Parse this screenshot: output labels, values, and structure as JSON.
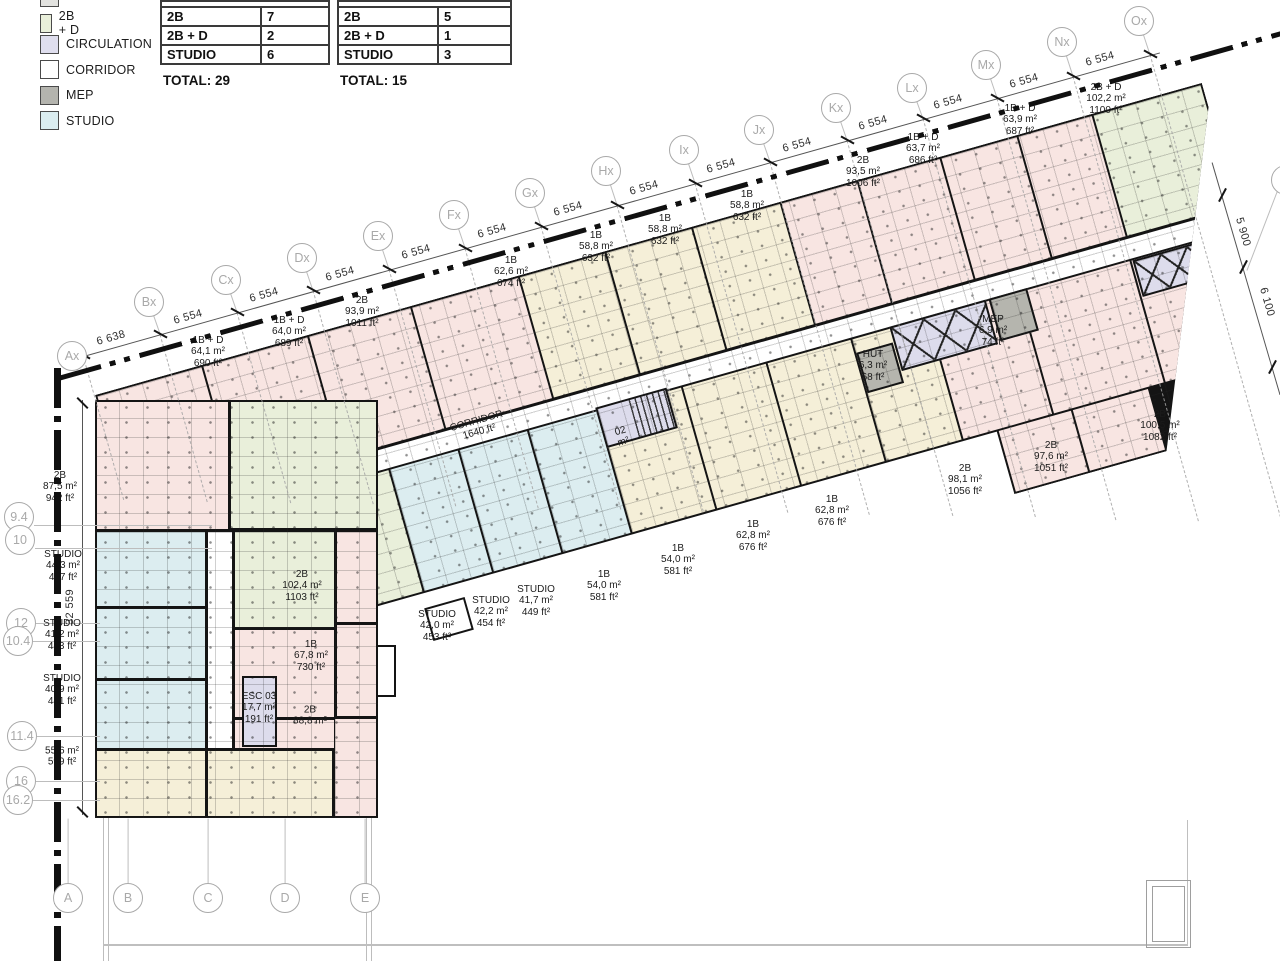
{
  "legend": {
    "items": [
      {
        "label": "2B + D",
        "color": "#e9efda"
      },
      {
        "label": "CIRCULATION",
        "color": "#dfdeee"
      },
      {
        "label": "CORRIDOR",
        "color": "#ffffff"
      },
      {
        "label": "MEP",
        "color": "#b4b4ae"
      },
      {
        "label": "STUDIO",
        "color": "#dbedf0"
      }
    ]
  },
  "tables": [
    {
      "rows": [
        [
          "2B",
          "7"
        ],
        [
          "2B + D",
          "2"
        ],
        [
          "STUDIO",
          "6"
        ]
      ],
      "total": "TOTAL: 29",
      "x": 160,
      "y": 0,
      "w": 170,
      "labelw": 100
    },
    {
      "rows": [
        [
          "2B",
          "5"
        ],
        [
          "2B + D",
          "1"
        ],
        [
          "STUDIO",
          "3"
        ]
      ],
      "total": "TOTAL: 15",
      "x": 337,
      "y": 0,
      "w": 175,
      "labelw": 100
    }
  ],
  "grid": {
    "top_bubbles": [
      {
        "label": "Ax",
        "x": 72,
        "y": 356
      },
      {
        "label": "Bx",
        "x": 149,
        "y": 302
      },
      {
        "label": "Cx",
        "x": 226,
        "y": 280
      },
      {
        "label": "Dx",
        "x": 302,
        "y": 258
      },
      {
        "label": "Ex",
        "x": 378,
        "y": 236
      },
      {
        "label": "Fx",
        "x": 454,
        "y": 215
      },
      {
        "label": "Gx",
        "x": 530,
        "y": 193
      },
      {
        "label": "Hx",
        "x": 606,
        "y": 171
      },
      {
        "label": "Ix",
        "x": 684,
        "y": 150
      },
      {
        "label": "Jx",
        "x": 759,
        "y": 130
      },
      {
        "label": "Kx",
        "x": 836,
        "y": 108
      },
      {
        "label": "Lx",
        "x": 912,
        "y": 88
      },
      {
        "label": "Mx",
        "x": 986,
        "y": 65
      },
      {
        "label": "Nx",
        "x": 1062,
        "y": 42
      },
      {
        "label": "Ox",
        "x": 1139,
        "y": 21
      }
    ],
    "left_bubbles": [
      {
        "label": "9.4",
        "x": 19,
        "y": 517
      },
      {
        "label": "10",
        "x": 20,
        "y": 540
      },
      {
        "label": "12",
        "x": 21,
        "y": 623
      },
      {
        "label": "10.4",
        "x": 18,
        "y": 641
      },
      {
        "label": "11.4",
        "x": 22,
        "y": 736
      },
      {
        "label": "16",
        "x": 21,
        "y": 781
      },
      {
        "label": "16.2",
        "x": 18,
        "y": 800
      }
    ],
    "bottom_bubbles": [
      {
        "label": "A",
        "x": 68,
        "y": 898
      },
      {
        "label": "B",
        "x": 128,
        "y": 898
      },
      {
        "label": "C",
        "x": 208,
        "y": 898
      },
      {
        "label": "D",
        "x": 285,
        "y": 898
      },
      {
        "label": "E",
        "x": 365,
        "y": 898
      }
    ],
    "right_partial_bubble": {
      "label": "",
      "x": 1286,
      "y": 180
    },
    "top_dims": [
      {
        "t": "6 638",
        "x": 111,
        "y": 338
      },
      {
        "t": "6 554",
        "x": 188,
        "y": 317
      },
      {
        "t": "6 554",
        "x": 264,
        "y": 295
      },
      {
        "t": "6 554",
        "x": 340,
        "y": 274
      },
      {
        "t": "6 554",
        "x": 416,
        "y": 252
      },
      {
        "t": "6 554",
        "x": 492,
        "y": 231
      },
      {
        "t": "6 554",
        "x": 568,
        "y": 209
      },
      {
        "t": "6 554",
        "x": 644,
        "y": 188
      },
      {
        "t": "6 554",
        "x": 721,
        "y": 166
      },
      {
        "t": "6 554",
        "x": 797,
        "y": 145
      },
      {
        "t": "6 554",
        "x": 873,
        "y": 123
      },
      {
        "t": "6 554",
        "x": 948,
        "y": 102
      },
      {
        "t": "6 554",
        "x": 1024,
        "y": 81
      },
      {
        "t": "6 554",
        "x": 1100,
        "y": 59
      }
    ],
    "right_dims": [
      {
        "t": "5 900",
        "x": 1243,
        "y": 232
      },
      {
        "t": "6 100",
        "x": 1267,
        "y": 302
      }
    ],
    "left_dim": {
      "t": "32 559",
      "x": 70,
      "y": 607
    }
  },
  "unit_labels": [
    {
      "x": 208,
      "y": 352,
      "lines": [
        "1B + D",
        "64,1 m²",
        "690 ft²"
      ]
    },
    {
      "x": 289,
      "y": 332,
      "lines": [
        "1B + D",
        "64,0 m²",
        "689 ft²"
      ]
    },
    {
      "x": 362,
      "y": 312,
      "lines": [
        "2B",
        "93,9 m²",
        "1011 ft²"
      ]
    },
    {
      "x": 511,
      "y": 272,
      "lines": [
        "1B",
        "62,6 m²",
        "674 ft²"
      ]
    },
    {
      "x": 596,
      "y": 247,
      "lines": [
        "1B",
        "58,8 m²",
        "632 ft²"
      ]
    },
    {
      "x": 665,
      "y": 230,
      "lines": [
        "1B",
        "58,8 m²",
        "632 ft²"
      ]
    },
    {
      "x": 747,
      "y": 206,
      "lines": [
        "1B",
        "58,8 m²",
        "632 ft²"
      ]
    },
    {
      "x": 863,
      "y": 172,
      "lines": [
        "2B",
        "93,5 m²",
        "1006 ft²"
      ]
    },
    {
      "x": 923,
      "y": 149,
      "lines": [
        "1B + D",
        "63,7 m²",
        "686 ft²"
      ]
    },
    {
      "x": 1020,
      "y": 120,
      "lines": [
        "1B + D",
        "63,9 m²",
        "687 ft²"
      ]
    },
    {
      "x": 1106,
      "y": 99,
      "lines": [
        "2B + D",
        "102,2 m²",
        "1100 ft²"
      ]
    },
    {
      "x": 60,
      "y": 487,
      "lines": [
        "2B",
        "87,5 m²",
        "942 ft²"
      ]
    },
    {
      "x": 63,
      "y": 566,
      "lines": [
        "STUDIO",
        "44,3 m²",
        "477 ft²"
      ]
    },
    {
      "x": 62,
      "y": 635,
      "lines": [
        "STUDIO",
        "41,2 m²",
        "443 ft²"
      ]
    },
    {
      "x": 62,
      "y": 690,
      "lines": [
        "STUDIO",
        "40,9 m²",
        "441 ft²"
      ]
    },
    {
      "x": 62,
      "y": 757,
      "lines": [
        "55,6 m²",
        "599 ft²"
      ]
    },
    {
      "x": 302,
      "y": 586,
      "lines": [
        "2B",
        "102,4 m²",
        "1103 ft²"
      ]
    },
    {
      "x": 311,
      "y": 656,
      "lines": [
        "1B",
        "67,8 m²",
        "730 ft²"
      ]
    },
    {
      "x": 259,
      "y": 708,
      "lines": [
        "ESC 03",
        "17,7 m²",
        "191 ft²"
      ]
    },
    {
      "x": 310,
      "y": 716,
      "lines": [
        "2B",
        "88,8 m²"
      ]
    },
    {
      "x": 437,
      "y": 626,
      "lines": [
        "STUDIO",
        "42,0 m²",
        "453 ft²"
      ]
    },
    {
      "x": 491,
      "y": 612,
      "lines": [
        "STUDIO",
        "42,2 m²",
        "454 ft²"
      ]
    },
    {
      "x": 536,
      "y": 601,
      "lines": [
        "STUDIO",
        "41,7 m²",
        "449 ft²"
      ]
    },
    {
      "x": 604,
      "y": 586,
      "lines": [
        "1B",
        "54,0 m²",
        "581 ft²"
      ]
    },
    {
      "x": 678,
      "y": 560,
      "lines": [
        "1B",
        "54,0 m²",
        "581 ft²"
      ]
    },
    {
      "x": 753,
      "y": 536,
      "lines": [
        "1B",
        "62,8 m²",
        "676 ft²"
      ]
    },
    {
      "x": 832,
      "y": 511,
      "lines": [
        "1B",
        "62,8 m²",
        "676 ft²"
      ]
    },
    {
      "x": 965,
      "y": 480,
      "lines": [
        "2B",
        "98,1 m²",
        "1056 ft²"
      ]
    },
    {
      "x": 1051,
      "y": 457,
      "lines": [
        "2B",
        "97,6 m²",
        "1051 ft²"
      ]
    },
    {
      "x": 1160,
      "y": 426,
      "lines": [
        "2B",
        "100,5 m²",
        "1082 ft²"
      ]
    },
    {
      "x": 873,
      "y": 366,
      "lines": [
        "HUT",
        "6,3 m²",
        "68 ft²"
      ]
    },
    {
      "x": 993,
      "y": 331,
      "lines": [
        "MEP",
        "6,9 m²",
        "74 ft²"
      ]
    },
    {
      "x": 478,
      "y": 427,
      "rot": -15.75,
      "lines": [
        "CORRIDOR",
        "1640 ft²"
      ]
    },
    {
      "x": 622,
      "y": 437,
      "rot": -15.75,
      "lines": [
        "02",
        "m²"
      ]
    }
  ],
  "building": {
    "band": {
      "cells": [
        {
          "x": 2,
          "y": 2,
          "w": 108,
          "h": 125,
          "c": "pink"
        },
        {
          "x": 112,
          "y": 2,
          "w": 108,
          "h": 125,
          "c": "pink"
        },
        {
          "x": 222,
          "y": 2,
          "w": 105,
          "h": 125,
          "c": "pink"
        },
        {
          "x": 329,
          "y": 2,
          "w": 110,
          "h": 125,
          "c": "pink"
        },
        {
          "x": 441,
          "y": 2,
          "w": 88,
          "h": 125,
          "c": "yellow"
        },
        {
          "x": 531,
          "y": 2,
          "w": 88,
          "h": 125,
          "c": "yellow"
        },
        {
          "x": 621,
          "y": 2,
          "w": 90,
          "h": 125,
          "c": "yellow"
        },
        {
          "x": 713,
          "y": 2,
          "w": 78,
          "h": 125,
          "c": "pink"
        },
        {
          "x": 793,
          "y": 2,
          "w": 84,
          "h": 125,
          "c": "pink"
        },
        {
          "x": 879,
          "y": 2,
          "w": 78,
          "h": 125,
          "c": "pink"
        },
        {
          "x": 959,
          "y": 2,
          "w": 76,
          "h": 125,
          "c": "pink"
        },
        {
          "x": 1037,
          "y": 2,
          "w": 111,
          "h": 125,
          "c": "green"
        },
        {
          "x": 140,
          "y": 130,
          "w": 1008,
          "h": 20,
          "c": "white"
        },
        {
          "x": 2,
          "y": 152,
          "w": 146,
          "h": 126,
          "c": "pink"
        },
        {
          "x": 150,
          "y": 152,
          "w": 112,
          "h": 126,
          "c": "green"
        },
        {
          "x": 264,
          "y": 152,
          "w": 70,
          "h": 126,
          "c": "cyan"
        },
        {
          "x": 336,
          "y": 152,
          "w": 70,
          "h": 126,
          "c": "cyan"
        },
        {
          "x": 408,
          "y": 152,
          "w": 70,
          "h": 126,
          "c": "cyan"
        },
        {
          "x": 480,
          "y": 152,
          "w": 86,
          "h": 126,
          "c": "yellow"
        },
        {
          "x": 568,
          "y": 152,
          "w": 86,
          "h": 126,
          "c": "yellow"
        },
        {
          "x": 656,
          "y": 152,
          "w": 86,
          "h": 126,
          "c": "yellow"
        },
        {
          "x": 744,
          "y": 152,
          "w": 78,
          "h": 126,
          "c": "yellow"
        },
        {
          "x": 824,
          "y": 152,
          "w": 92,
          "h": 126,
          "c": "pink"
        },
        {
          "x": 918,
          "y": 152,
          "w": 114,
          "h": 126,
          "c": "pink"
        },
        {
          "x": 1034,
          "y": 152,
          "w": 114,
          "h": 126,
          "c": "pink"
        },
        {
          "x": 860,
          "y": 280,
          "w": 75,
          "h": 63,
          "c": "pink"
        },
        {
          "x": 937,
          "y": 280,
          "w": 78,
          "h": 63,
          "c": "pink"
        }
      ],
      "shafts": [
        {
          "x": 478,
          "y": 148,
          "w": 74,
          "h": 42,
          "c": "lavender",
          "hatch": true,
          "name": "stair-esc-02"
        },
        {
          "x": 783,
          "y": 150,
          "w": 100,
          "h": 46,
          "c": "lavender",
          "xbrace": true,
          "name": "elevator-core"
        },
        {
          "x": 744,
          "y": 166,
          "w": 38,
          "h": 42,
          "c": "gray",
          "name": "hut-room"
        },
        {
          "x": 886,
          "y": 150,
          "w": 40,
          "h": 44,
          "c": "gray",
          "name": "mep-room"
        },
        {
          "x": 1035,
          "y": 152,
          "w": 80,
          "h": 38,
          "c": "lavender",
          "xbrace": true,
          "name": "elevator-tip"
        }
      ]
    },
    "wing": {
      "cells": [
        {
          "x": 2,
          "y": 2,
          "w": 131,
          "h": 127,
          "c": "pink"
        },
        {
          "x": 136,
          "y": 2,
          "w": 145,
          "h": 126,
          "c": "green"
        },
        {
          "x": 2,
          "y": 132,
          "w": 108,
          "h": 74,
          "c": "cyan"
        },
        {
          "x": 2,
          "y": 209,
          "w": 108,
          "h": 69,
          "c": "cyan"
        },
        {
          "x": 2,
          "y": 281,
          "w": 108,
          "h": 67,
          "c": "cyan"
        },
        {
          "x": 2,
          "y": 351,
          "w": 108,
          "h": 65,
          "c": "yellow"
        },
        {
          "x": 113,
          "y": 351,
          "w": 124,
          "h": 65,
          "c": "yellow"
        },
        {
          "x": 113,
          "y": 132,
          "w": 24,
          "h": 216,
          "c": "white"
        },
        {
          "x": 140,
          "y": 132,
          "w": 99,
          "h": 95,
          "c": "green"
        },
        {
          "x": 140,
          "y": 230,
          "w": 99,
          "h": 87,
          "c": "pink"
        },
        {
          "x": 140,
          "y": 320,
          "w": 99,
          "h": 28,
          "c": "pink"
        },
        {
          "x": 242,
          "y": 132,
          "w": 39,
          "h": 90,
          "c": "pink"
        },
        {
          "x": 242,
          "y": 225,
          "w": 39,
          "h": 91,
          "c": "pink"
        },
        {
          "x": 240,
          "y": 319,
          "w": 41,
          "h": 97,
          "c": "pink"
        }
      ],
      "shafts": [
        {
          "x": 147,
          "y": 276,
          "w": 35,
          "h": 71,
          "c": "lavender",
          "name": "stair-esc-03"
        }
      ]
    }
  },
  "colors": {
    "pink": "#f8e5e2",
    "yellow": "#f5efd8",
    "green": "#e9efda",
    "cyan": "#dcedf0",
    "lavender": "#dddcec",
    "gray": "#b5b5ae",
    "white": "#ffffff",
    "wall": "#141414",
    "bubble": "#a9a9a9"
  }
}
